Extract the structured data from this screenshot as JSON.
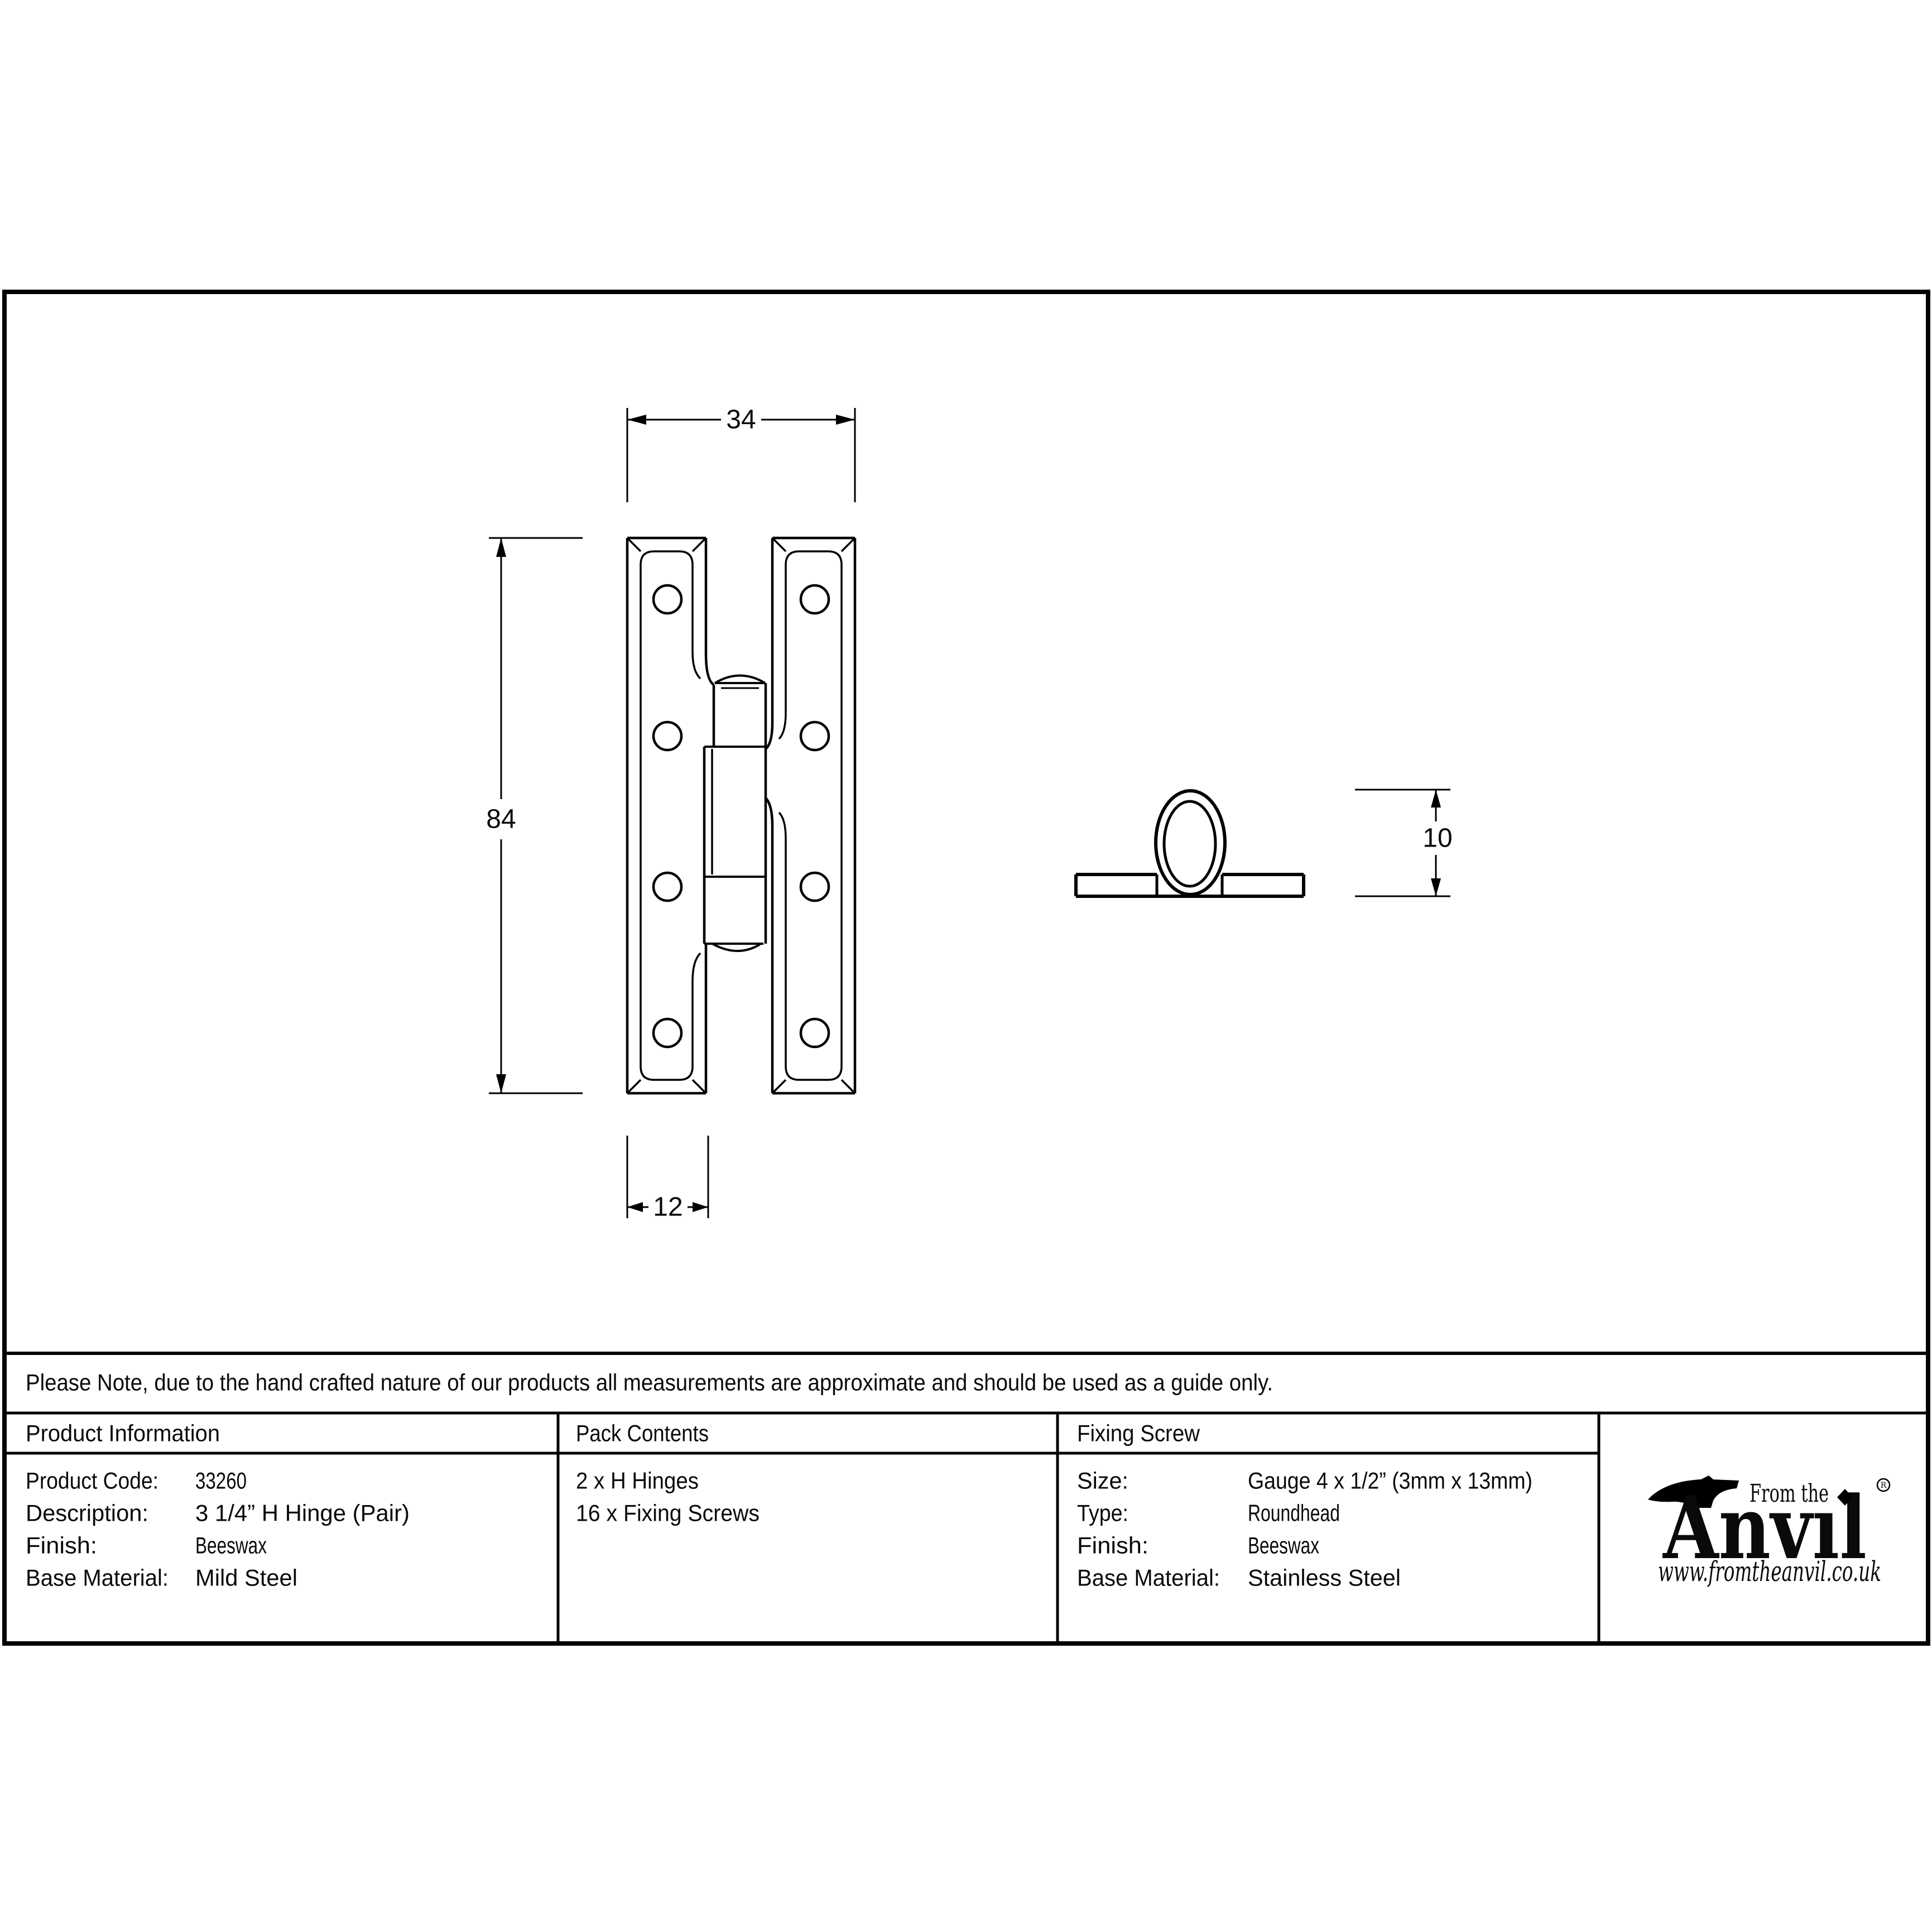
{
  "colors": {
    "ink": "#000000",
    "paper": "#ffffff"
  },
  "drawing": {
    "front_view": {
      "width_mm": "34",
      "height_mm": "84",
      "leaf_width_mm": "12"
    },
    "side_view": {
      "knuckle_diameter_mm": "10"
    }
  },
  "note": "Please Note, due to the hand crafted nature of our products all measurements are approximate and should be used as a guide only.",
  "table": {
    "product_information": {
      "header": "Product Information",
      "rows": [
        {
          "label": "Product Code:",
          "value": "33260"
        },
        {
          "label": "Description:",
          "value": "3 1/4” H Hinge (Pair)"
        },
        {
          "label": "Finish:",
          "value": "Beeswax"
        },
        {
          "label": "Base Material:",
          "value": "Mild Steel"
        }
      ]
    },
    "pack_contents": {
      "header": "Pack Contents",
      "items": [
        "2 x H Hinges",
        "16 x Fixing Screws"
      ]
    },
    "fixing_screw": {
      "header": "Fixing Screw",
      "rows": [
        {
          "label": "Size:",
          "value": "Gauge 4 x 1/2” (3mm x 13mm)"
        },
        {
          "label": "Type:",
          "value": "Roundhead"
        },
        {
          "label": "Finish:",
          "value": "Beeswax"
        },
        {
          "label": "Base Material:",
          "value": "Stainless Steel"
        }
      ]
    }
  },
  "logo": {
    "tagline": "From the",
    "brand": "Anvıl",
    "registered_mark": "R",
    "website": "www.fromtheanvil.co.uk"
  }
}
